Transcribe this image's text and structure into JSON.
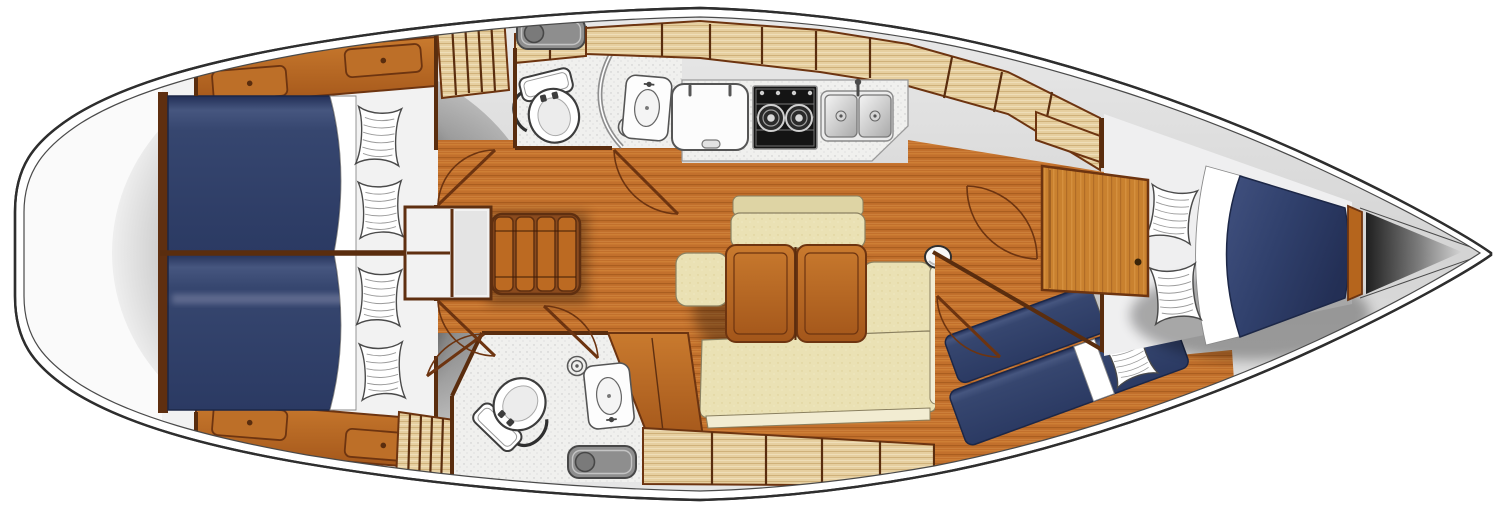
{
  "title": "Sailing yacht interior layout plan",
  "diagram_type": "yacht-floor-plan",
  "orientation": {
    "stern": "left",
    "bow": "right"
  },
  "features": [
    {
      "name": "hull-outline",
      "label": "Hull and deck outline"
    },
    {
      "name": "stern-locker-shadow",
      "label": "Shaded stern / cockpit area"
    },
    {
      "name": "aft-cabin-port",
      "label": "Aft double cabin (top), navy berth with two pillows and locker shelf"
    },
    {
      "name": "aft-cabin-starboard",
      "label": "Aft double cabin (bottom), navy berth with two pillows and locker shelf"
    },
    {
      "name": "engine-compartment",
      "label": "Engine box between aft cabins"
    },
    {
      "name": "companionway-stairs",
      "label": "Companionway steps, four treads"
    },
    {
      "name": "head-port",
      "label": "Forward-facing wet head with toilet, shower drain and washbasin"
    },
    {
      "name": "deck-hatch-port",
      "label": "Grey deck hatch"
    },
    {
      "name": "galley",
      "label": "Galley with fridge lid, two-burner stove and double stainless sink"
    },
    {
      "name": "overhead-lockers",
      "label": "Light wood lockers along hull side"
    },
    {
      "name": "saloon",
      "label": "Saloon with folding two-leaf table, bench, stool and L-shaped settee"
    },
    {
      "name": "mast-post",
      "label": "Mast compression post"
    },
    {
      "name": "head-starboard",
      "label": "Aft starboard head with toilet, washbasin, shower drain and hatch"
    },
    {
      "name": "hanging-lockers",
      "label": "Slatted hanging lockers"
    },
    {
      "name": "forward-cabin",
      "label": "Forward owner cabin with tapered navy V-berth and two pillows"
    },
    {
      "name": "forward-cabin-door",
      "label": "Wood door panel to forward cabin"
    },
    {
      "name": "bunk-cabin",
      "label": "Starboard forward cabin with two diagonal single berths"
    },
    {
      "name": "anchor-locker",
      "label": "Dark anchor locker at bow"
    },
    {
      "name": "door-swings",
      "label": "Door swing arcs"
    }
  ],
  "counts": {
    "cabins": 4,
    "heads": 2,
    "double_berths": 3,
    "single_berths": 2,
    "pillows": 8
  },
  "colors": {
    "hull_line": "#2e2e2e",
    "deck_gray": "#d8d8d8",
    "floor_wood": "#c2702c",
    "furniture_wood": "#b5651d",
    "wood_frame": "#6d3410",
    "wall": "#5a2d0e",
    "locker_wood": "#e6cfa0",
    "cushion_cream": "#eae1b4",
    "bed_navy": "#33426e",
    "pillow_white": "#ffffff",
    "fixture_white": "#fdfdfd",
    "stove_black": "#141414",
    "metal_gray": "#c0c0c0",
    "hatch_gray": "#8e8e8e",
    "shadow_gray": "#3c3c3c"
  }
}
